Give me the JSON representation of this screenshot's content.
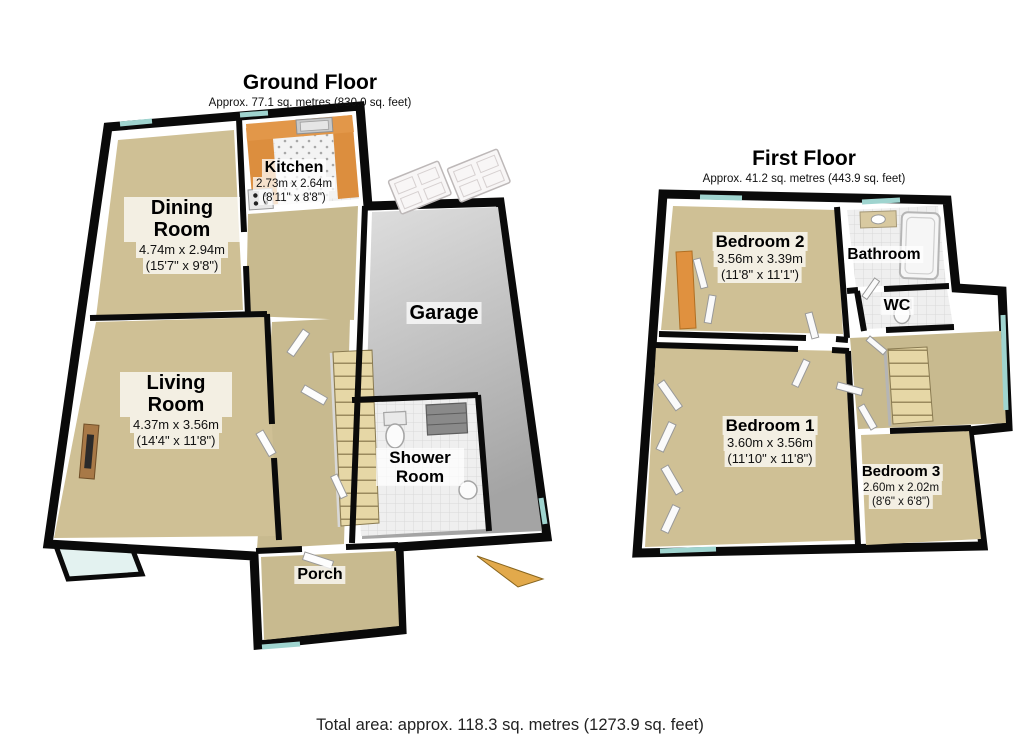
{
  "ground_floor": {
    "title": "Ground Floor",
    "subtitle": "Approx. 77.1 sq. metres (830.0 sq. feet)",
    "rooms": {
      "dining": {
        "name": "Dining Room",
        "dim_m": "4.74m x 2.94m",
        "dim_ft": "(15'7\" x 9'8\")"
      },
      "kitchen": {
        "name": "Kitchen",
        "dim_m": "2.73m x 2.64m",
        "dim_ft": "(8'11\" x 8'8\")"
      },
      "garage": {
        "name": "Garage"
      },
      "living": {
        "name": "Living Room",
        "dim_m": "4.37m x 3.56m",
        "dim_ft": "(14'4\" x 11'8\")"
      },
      "shower": {
        "name": "Shower Room"
      },
      "porch": {
        "name": "Porch"
      }
    }
  },
  "first_floor": {
    "title": "First Floor",
    "subtitle": "Approx. 41.2 sq. metres (443.9 sq. feet)",
    "rooms": {
      "bedroom2": {
        "name": "Bedroom 2",
        "dim_m": "3.56m x 3.39m",
        "dim_ft": "(11'8\" x 11'1\")"
      },
      "bathroom": {
        "name": "Bathroom"
      },
      "wc": {
        "name": "WC"
      },
      "bedroom1": {
        "name": "Bedroom 1",
        "dim_m": "3.60m x 3.56m",
        "dim_ft": "(11'10\" x 11'8\")"
      },
      "bedroom3": {
        "name": "Bedroom 3",
        "dim_m": "2.60m x 2.02m",
        "dim_ft": "(8'6\" x 6'8\")"
      }
    }
  },
  "footer": {
    "total": "Total area: approx. 118.3 sq. metres (1273.9 sq. feet)"
  },
  "colors": {
    "wall": "#0a0a0a",
    "carpet": "#cfc095",
    "hall_carpet": "#c8ba8f",
    "garage_floor": "#ababab",
    "tile": "#efefef",
    "kitchen_counter": "#dc8e3e",
    "stairs": "#e6d7a6",
    "window": "#9fd4cf",
    "front_door": "#e2a94b",
    "label_bg": "rgba(255,255,255,0.74)"
  }
}
